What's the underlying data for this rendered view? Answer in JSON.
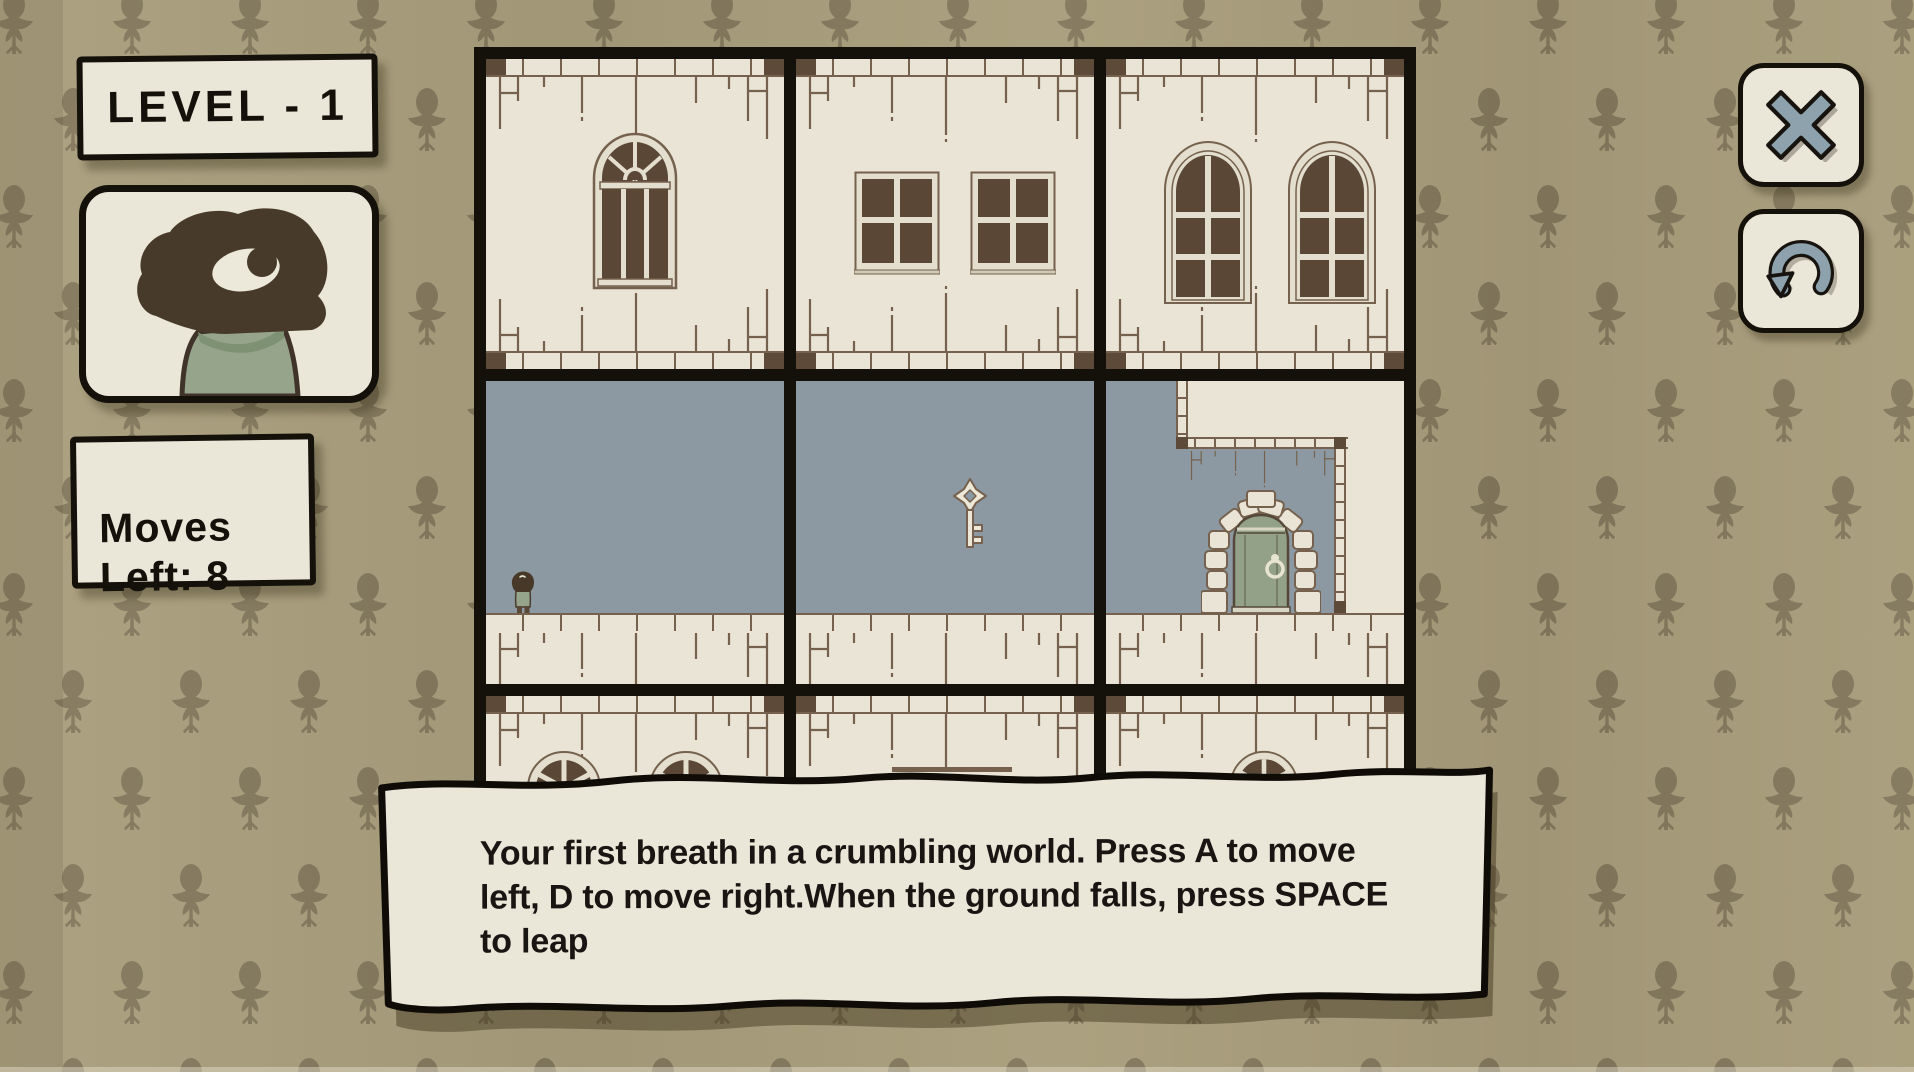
{
  "app": {
    "screen": "level-gameplay"
  },
  "hud": {
    "level_label": "LEVEL - 1",
    "level_number": 1,
    "moves_label": "Moves\nLeft: 8",
    "moves_left": 8,
    "portrait": "one-eyed-bird-character"
  },
  "toolbar": {
    "close_icon": "x-icon",
    "restart_icon": "restart-arrow-icon"
  },
  "tutorial": {
    "text": "Your first breath in a crumbling world. Press A to move left, D to move right.When the ground falls, press SPACE to leap"
  },
  "board": {
    "grid": {
      "rows": 3,
      "cols": 3
    },
    "rooms": [
      "wall-room-arched-fan-window",
      "wall-room-two-square-windows",
      "wall-room-two-arched-windows",
      "interior-room-with-player",
      "interior-room-with-key",
      "interior-room-with-door",
      "wall-room-round-windows",
      "wall-room-ledge",
      "wall-room-round-window"
    ],
    "entities": {
      "player": "bird-player",
      "key": "level-key",
      "door": "exit-door"
    }
  },
  "colors": {
    "wallpaper_base": "#a89d7b",
    "wallpaper_motif": "#7d7258",
    "panel_cream": "#eae6d8",
    "room_cream": "#e9e4d5",
    "ink": "#14100a",
    "brick": "#75614d",
    "brick_dark": "#5e4a38",
    "pane_brown": "#5a4736",
    "interior_blue": "#8c99a2",
    "sage": "#96a48b",
    "door_sage": "#93a188",
    "icon_gray": "#8da2ac",
    "text_dark": "#191512"
  }
}
